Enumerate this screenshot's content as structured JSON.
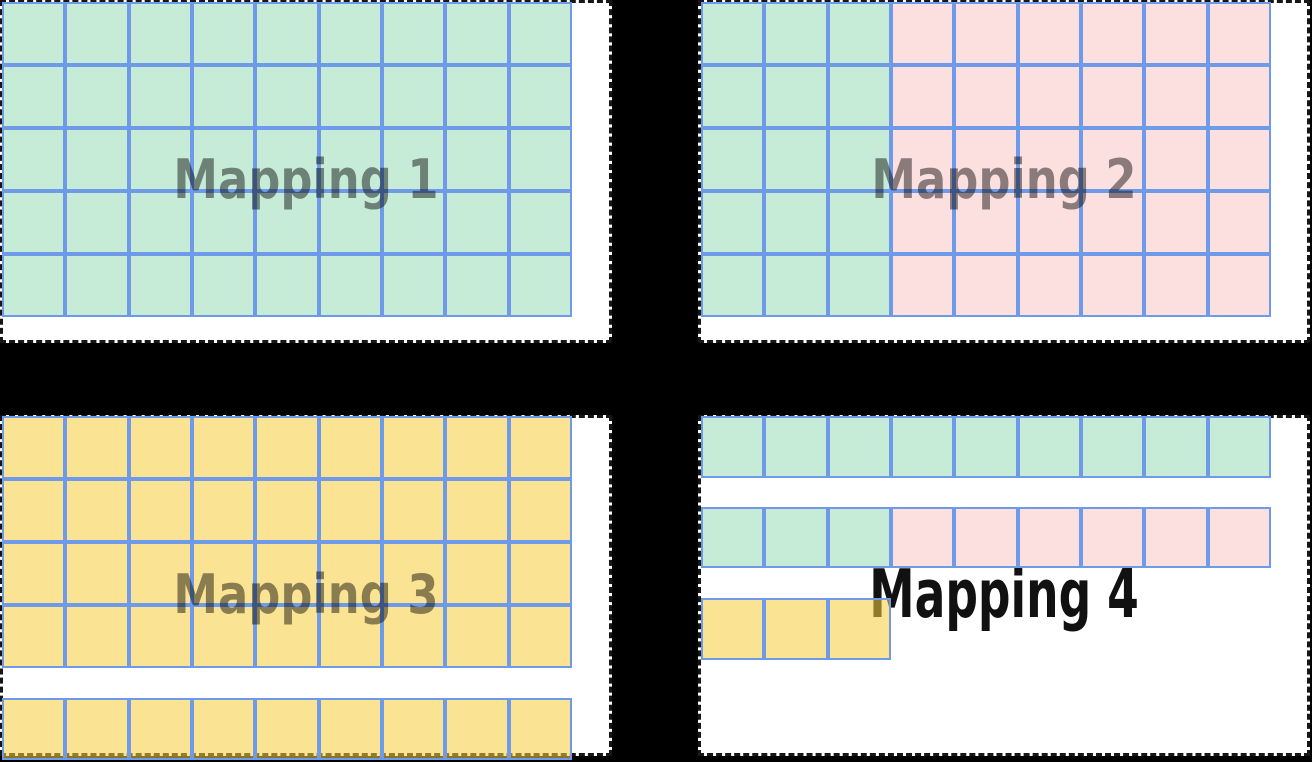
{
  "canvas": {
    "width": 1312,
    "height": 761
  },
  "colors": {
    "background": "#000000",
    "panel_fill": "#ffffff",
    "panel_dash": "#161616",
    "cell_border": "#6e9ae9",
    "green_fill": "rgba(106,205,150,0.38)",
    "pink_fill": "rgba(247,172,170,0.38)",
    "yellow_fill": "rgba(246,205,62,0.56)",
    "label_overlay_color": "rgba(0,0,0,0.45)",
    "label_solid_color": "#111111"
  },
  "mappings": [
    {
      "label": "Mapping 1",
      "blocks": [
        {
          "rows": 5,
          "row": [
            {
              "color": "green",
              "count": 9
            }
          ]
        }
      ]
    },
    {
      "label": "Mapping 2",
      "blocks": [
        {
          "rows": 5,
          "row": [
            {
              "color": "green",
              "count": 3
            },
            {
              "color": "pink",
              "count": 6
            }
          ]
        }
      ]
    },
    {
      "label": "Mapping 3",
      "blocks": [
        {
          "rows": 4,
          "row": [
            {
              "color": "yellow",
              "count": 9
            }
          ]
        },
        {
          "rows": 1,
          "row": [
            {
              "color": "yellow",
              "count": 9
            }
          ]
        }
      ]
    },
    {
      "label": "Mapping 4",
      "blocks": [
        {
          "rows": 1,
          "row": [
            {
              "color": "green",
              "count": 9
            }
          ]
        },
        {
          "rows": 1,
          "row": [
            {
              "color": "green",
              "count": 3
            },
            {
              "color": "pink",
              "count": 6
            }
          ]
        },
        {
          "rows": 1,
          "row": [
            {
              "color": "yellow",
              "count": 3
            }
          ]
        }
      ]
    }
  ]
}
